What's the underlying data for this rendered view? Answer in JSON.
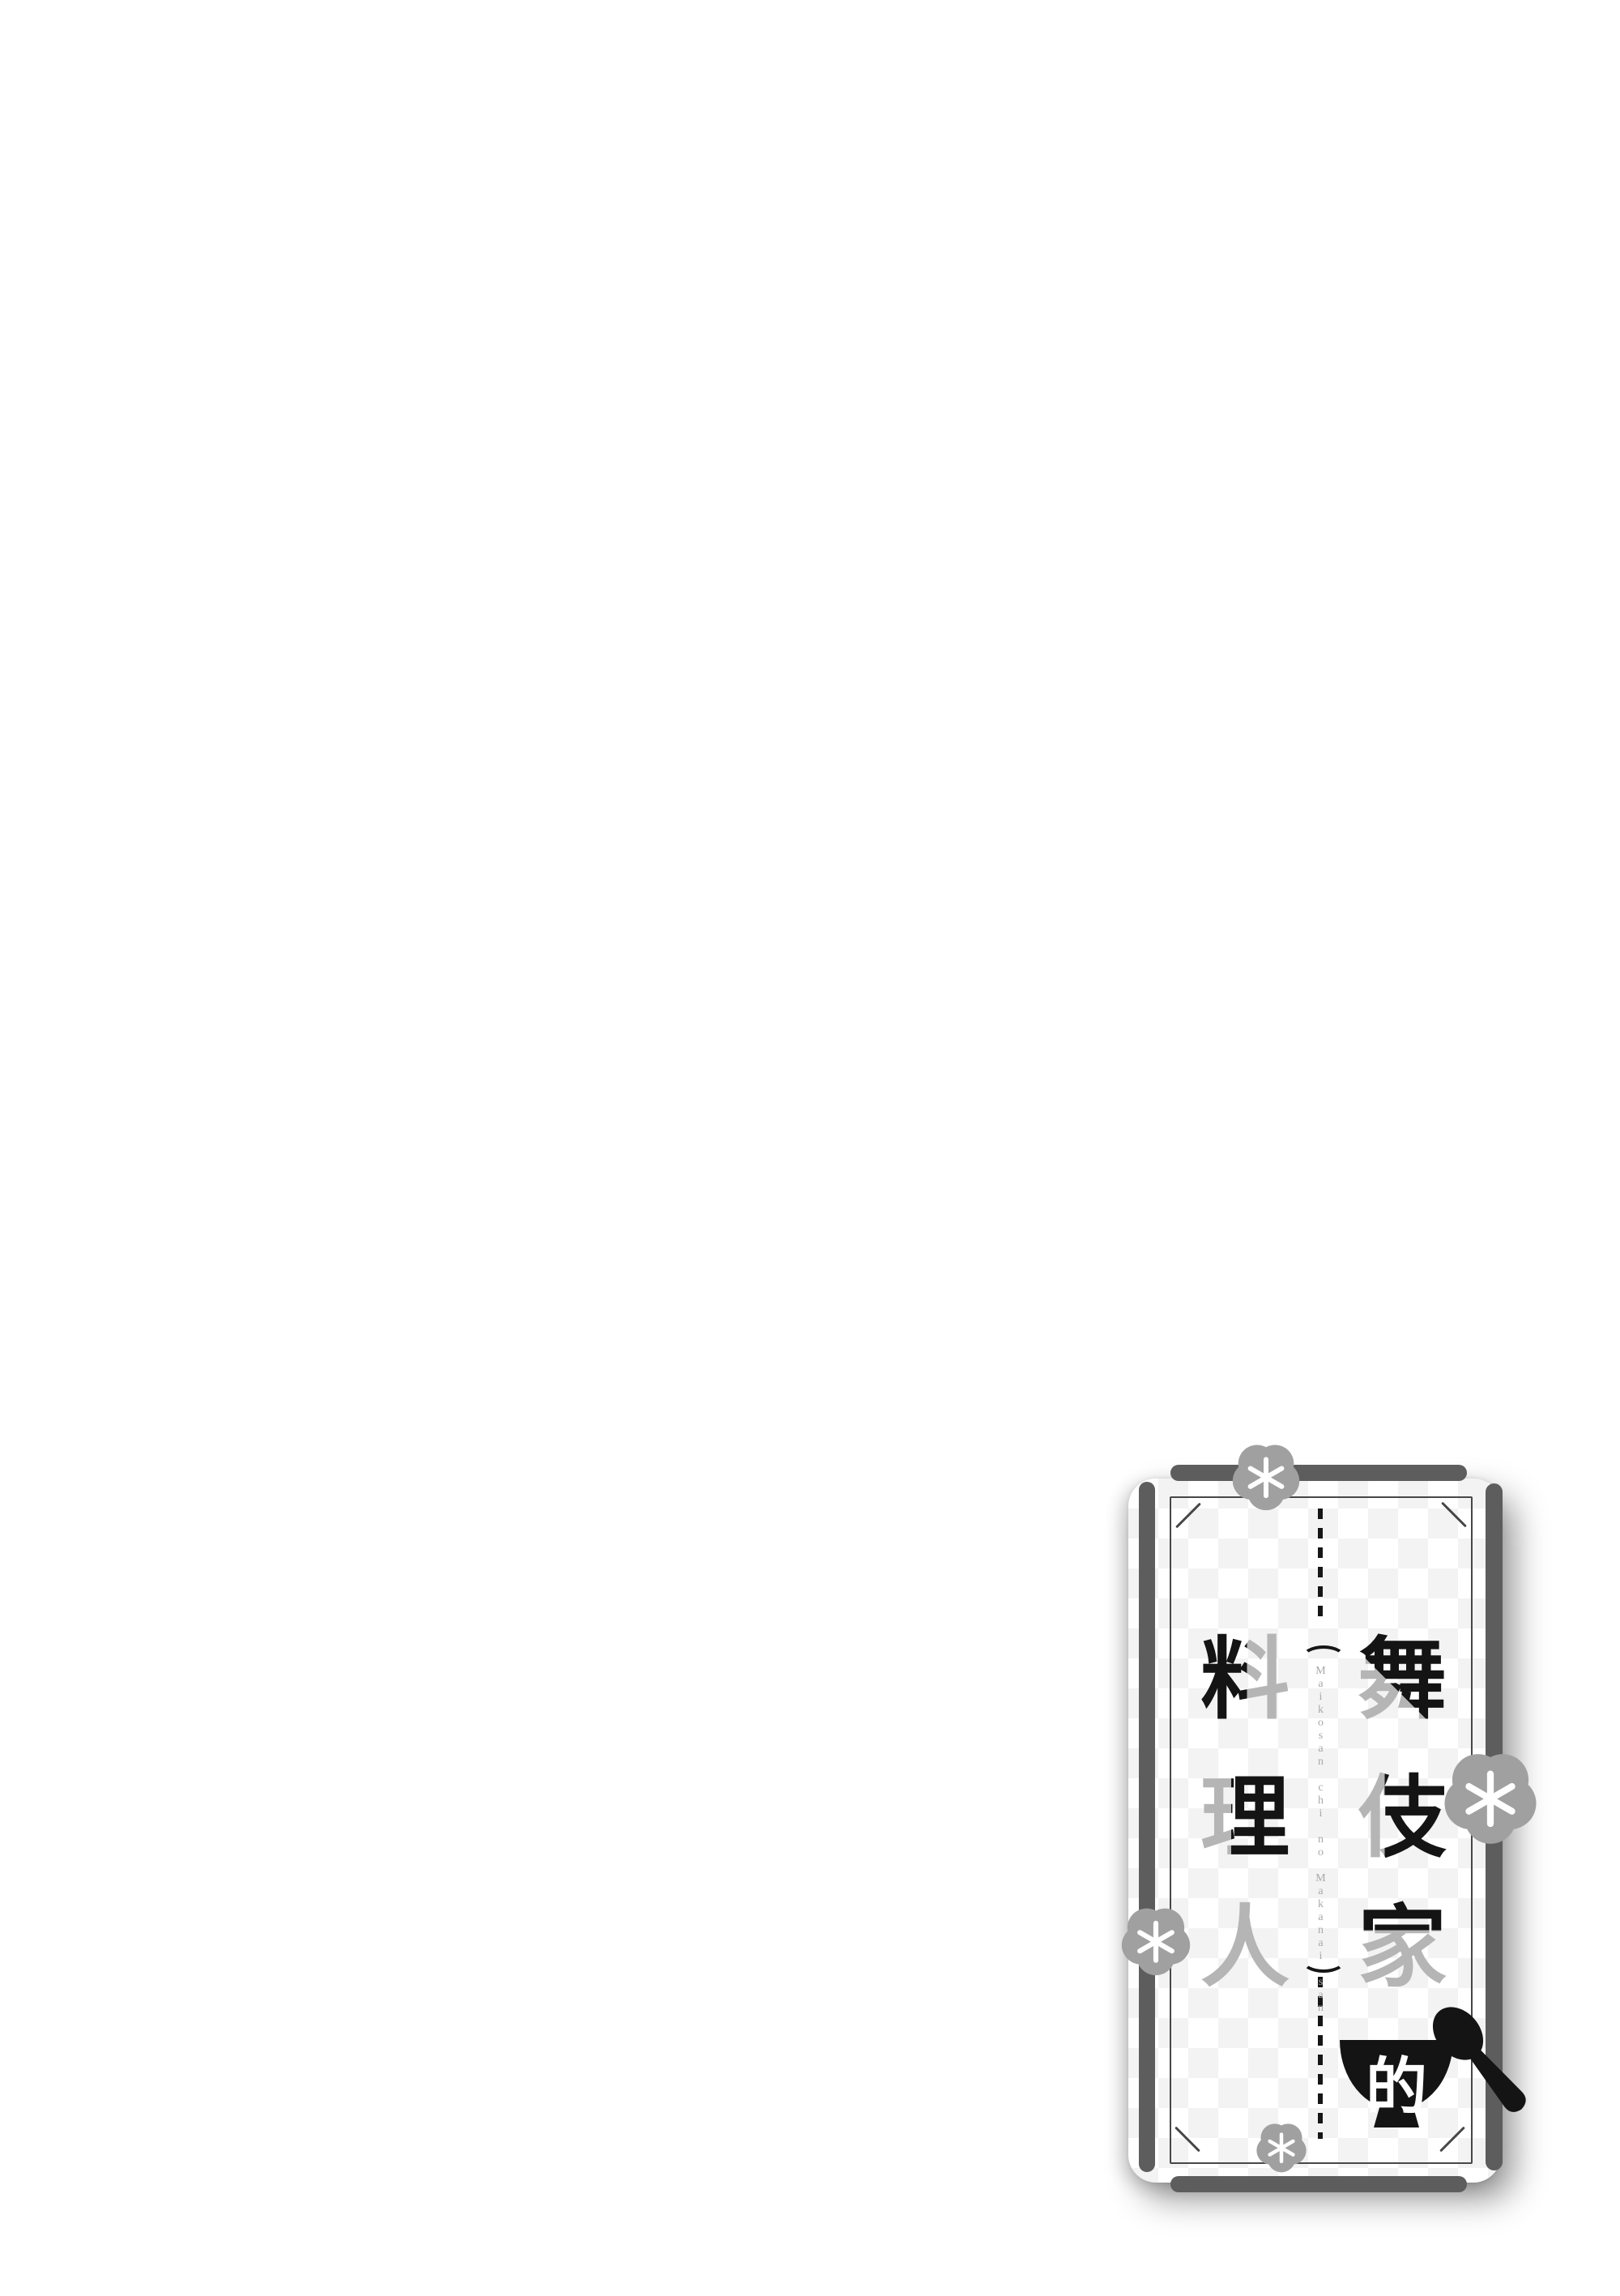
{
  "page": {
    "background_color": "#ffffff"
  },
  "logo_card": {
    "title_full": "舞伎家的料理人",
    "right_column_chars": [
      "舞",
      "伎",
      "家"
    ],
    "left_column_chars": [
      "料",
      "理",
      "人"
    ],
    "bowl_char": "的",
    "romaji": "Maikosan chi no Makanai san",
    "parens": [
      "(",
      ")"
    ],
    "icons": [
      "plum-blossom",
      "plum-blossom",
      "plum-blossom",
      "plum-blossom",
      "rice-bowl",
      "spoon"
    ],
    "colors": {
      "frame_rod_gray": "#5d5d5d",
      "inner_border_gray": "#474747",
      "flower_gray": "#a0a0a0",
      "stroke_gray": "#b5b5b5",
      "ink_black": "#141414",
      "romaji_gray": "#a9a9a9",
      "checker_light_gray": "#f3f3f3",
      "card_white": "#ffffff",
      "bowl_char_white": "#ffffff"
    }
  }
}
